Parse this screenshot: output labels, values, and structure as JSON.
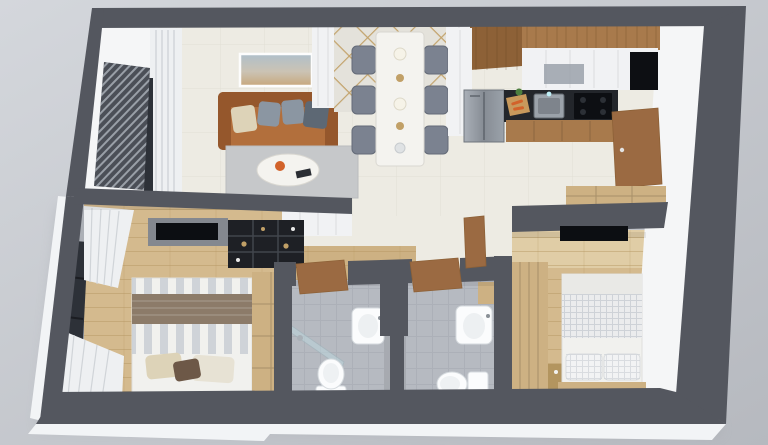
{
  "scene": {
    "type": "3d-apartment-floor-plan-render",
    "view": "isometric-top-down-dollhouse",
    "rooms": [
      {
        "name": "living-room",
        "objects": [
          "leather-sofa",
          "throw-cushions",
          "marble-coffee-table",
          "area-rug",
          "wall-art",
          "window-curtains"
        ]
      },
      {
        "name": "dining-area",
        "objects": [
          "marble-dining-table",
          "dining-chairs",
          "mirror-lattice-wall",
          "table-decor"
        ]
      },
      {
        "name": "kitchen",
        "objects": [
          "upper-wood-cabinets",
          "white-cabinets",
          "glass-cabinet",
          "tall-pantry",
          "refrigerator",
          "black-counter",
          "sink",
          "cooktop",
          "cutting-board",
          "base-cabinets"
        ]
      },
      {
        "name": "entry-hall",
        "objects": [
          "entrance-door",
          "shoe-cabinet"
        ]
      },
      {
        "name": "bedroom-1",
        "objects": [
          "double-bed",
          "striped-duvet",
          "brown-runner",
          "pillows",
          "oak-wardrobe",
          "tv-panel",
          "black-open-shelving",
          "window",
          "pleated-curtains"
        ]
      },
      {
        "name": "bathroom-1",
        "objects": [
          "toilet",
          "wall-basin",
          "shower-glass",
          "wood-door"
        ]
      },
      {
        "name": "bathroom-2",
        "objects": [
          "toilet",
          "wall-basin",
          "wood-door",
          "wood-shelf"
        ]
      },
      {
        "name": "bedroom-2",
        "objects": [
          "double-bed",
          "waffle-blanket",
          "pillows",
          "slatted-wardrobe",
          "bedside-table",
          "tv-panel",
          "wood-door"
        ]
      },
      {
        "name": "balcony",
        "objects": [
          "louver-screen",
          "window-frames"
        ]
      }
    ],
    "counts": {
      "bedrooms": 2,
      "bathrooms": 2,
      "dining-chairs": 6
    }
  },
  "colors": {
    "backdrop-top": "#d4d7dc",
    "backdrop-bottom": "#b6b9bf",
    "shadow": "#8f939a",
    "slab": "#f2f4f6",
    "wall-dark": "#54575f",
    "wall-face": "#f5f6f7",
    "floor-cream": "#edebe3",
    "floor-tile-line": "#dfdcd2",
    "wood-floor": "#d4ba8e",
    "wood-floor-pale": "#e0cda6",
    "plank-line": "#b3945f",
    "bath-tile": "#b6bac1",
    "grout": "#a3a8b0",
    "rug": "#c6c8ca",
    "sofa": "#b26f3c",
    "sofa-dark": "#95572c",
    "cushion-beige": "#d8c8a2",
    "cushion-gray": "#8b96a2",
    "cushion-dark": "#5d6874",
    "marble": "#f4f3ef",
    "chair": "#7b8290",
    "chair-dark": "#646b78",
    "mirror": "#e4e2db",
    "lattice-gold": "#c1a067",
    "wood-cabinet": "#a87a4c",
    "wood-cabinet-dark": "#8d6137",
    "cabinet-white": "#f1f2f4",
    "seam": "#d8d9dc",
    "counter": "#23262b",
    "appliance": "#0d0f13",
    "steel": "#9ba2aa",
    "steel-dark": "#7e848c",
    "door-wood": "#9b6a42",
    "oak": "#cdb183",
    "oak-dark": "#b3955f",
    "shelf-black": "#1e2025",
    "shelf-line": "#41454c",
    "tv": "#0c0e12",
    "panel-gray": "#84888f",
    "curtain": "#eef0f2",
    "curtain-line": "#d0d4d8",
    "bed-white": "#f1f1ee",
    "stripe": "#c7ccd2",
    "runner": "#8c7b69",
    "pillow-brown": "#6d5847",
    "pillow-beige": "#ddd3b8",
    "pillow-cream": "#e7e2d4",
    "waffle": "#ced2d7",
    "porcelain": "#fbfcfd",
    "porcelain-line": "#d5dade",
    "glass": "#bdd7de",
    "window-glass": "#2d3138",
    "frame": "#1b1d22",
    "art-sky": "#afbfca",
    "art-sand": "#c7a77c",
    "green": "#4d7f3f",
    "carrot": "#d2622a"
  }
}
